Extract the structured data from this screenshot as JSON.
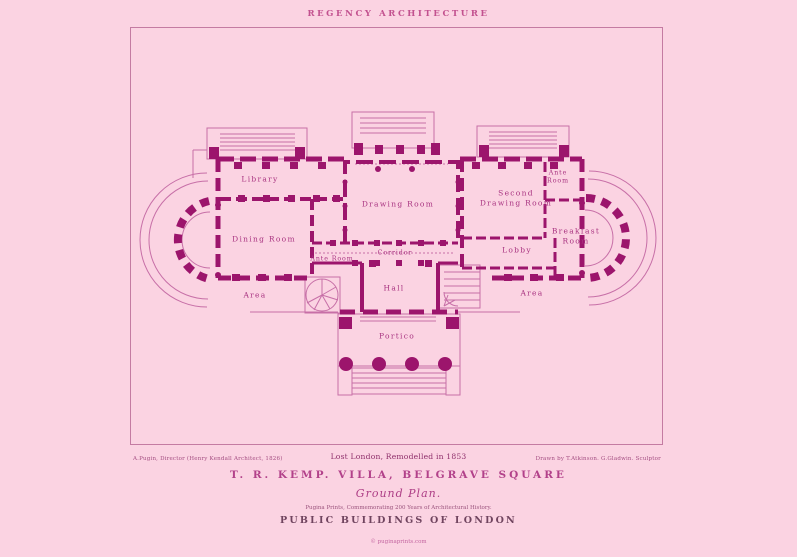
{
  "page": {
    "header_title": "REGENCY ARCHITECTURE",
    "caption_left": "A.Pugin, Director (Henry Kendall Architect, 1826)",
    "caption_center": "Lost London, Remodelled in 1853",
    "caption_right": "Drawn by T.Atkinson. G.Gladwin. Sculptor",
    "villa_title": "T. R. KEMP. VILLA, BELGRAVE SQUARE",
    "plan_label": "Ground Plan.",
    "note": "Pugina Prints, Commemorating 200 Years of Architectural History.",
    "series_title": "PUBLIC BUILDINGS OF LONDON",
    "copyright": "© puginaprints.com"
  },
  "plan": {
    "rooms": {
      "library": {
        "label": "Library"
      },
      "dining_room": {
        "label": "Dining Room"
      },
      "ante_room_left": {
        "label": "Ante Room"
      },
      "area_left": {
        "label": "Area"
      },
      "drawing_room": {
        "label": "Drawing Room"
      },
      "corridor": {
        "label": "Corridor"
      },
      "hall": {
        "label": "Hall"
      },
      "second_drawing_room": {
        "line1": "Second",
        "line2": "Drawing Room"
      },
      "ante_room_right": {
        "line1": "Ante",
        "line2": "Room"
      },
      "breakfast_room": {
        "line1": "Breakfast",
        "line2": "Room"
      },
      "lobby": {
        "label": "Lobby"
      },
      "area_right": {
        "label": "Area"
      },
      "portico": {
        "label": "Portico"
      }
    }
  },
  "colors": {
    "background": "#fbd3e2",
    "wall_ink": "#9c156c",
    "light_ink": "#c76fa7",
    "label_ink": "#a83380",
    "title_ink": "#b2418a",
    "dark_ink": "#70445f",
    "frame_line": "#c47ba2"
  }
}
